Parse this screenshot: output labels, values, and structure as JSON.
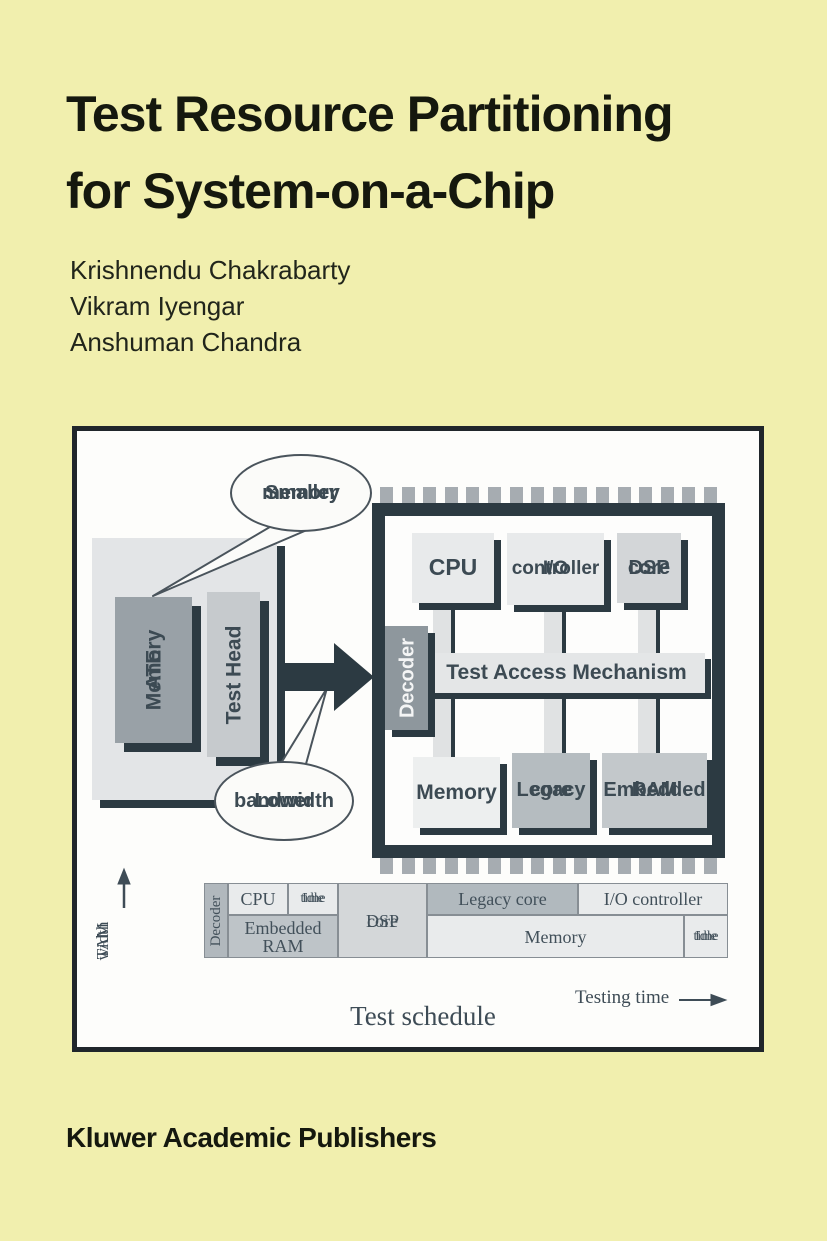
{
  "cover": {
    "title": [
      "Test Resource Partitioning",
      "for System-on-a-Chip"
    ],
    "authors": [
      "Krishnendu Chakrabarty",
      "Vikram Iyengar",
      "Anshuman Chandra"
    ],
    "publisher": "Kluwer Academic Publishers"
  },
  "colors": {
    "cover_background": "#f1efae",
    "dark_slate_accent": "#2c3a42",
    "diagram_label_text": "#3c4a53",
    "figure_border": "#20262b"
  },
  "figure": {
    "callouts": {
      "smaller_memory": [
        "Smaller",
        "memory"
      ],
      "lower_bandwidth": [
        "Lower",
        "bandwidth"
      ]
    },
    "ate": {
      "memory": [
        "ATE",
        "Memory"
      ],
      "test_head": "Test Head"
    },
    "chip": {
      "cpu": "CPU",
      "io": [
        "I/O",
        "controller"
      ],
      "dsp": [
        "DSP",
        "core"
      ],
      "decoder": "Decoder",
      "tam": "Test Access Mechanism",
      "memory": "Memory",
      "legacy": [
        "Legacy",
        "core"
      ],
      "ram": [
        "Embedded",
        "RAM"
      ],
      "pins_top": 16,
      "pins_bottom": 16
    },
    "schedule": {
      "tam_width": [
        "TAM",
        "width"
      ],
      "testing_time": "Testing time",
      "caption": "Test schedule",
      "cells": {
        "decoder": "Decoder",
        "cpu": "CPU",
        "idle_top": [
          "Idle",
          "time"
        ],
        "embedded_ram": "Embedded RAM",
        "dsp": [
          "DSP",
          "core"
        ],
        "legacy": "Legacy core",
        "io": "I/O controller",
        "memory": "Memory",
        "idle_bottom": [
          "Idle",
          "time"
        ]
      }
    }
  },
  "chart_data": {
    "type": "gantt",
    "title": "Test schedule",
    "xlabel": "Testing time",
    "ylabel": "TAM width",
    "axis_ticks": "none shown",
    "segments": [
      {
        "label": "Decoder",
        "row": "full",
        "start": 0.0,
        "end": 0.046
      },
      {
        "label": "CPU",
        "row": "top",
        "start": 0.046,
        "end": 0.16
      },
      {
        "label": "Idle time",
        "row": "top",
        "start": 0.16,
        "end": 0.256
      },
      {
        "label": "Embedded RAM",
        "row": "bottom",
        "start": 0.046,
        "end": 0.256
      },
      {
        "label": "DSP core",
        "row": "full",
        "start": 0.256,
        "end": 0.426
      },
      {
        "label": "Legacy core",
        "row": "top",
        "start": 0.426,
        "end": 0.714
      },
      {
        "label": "I/O controller",
        "row": "top",
        "start": 0.714,
        "end": 1.0
      },
      {
        "label": "Memory",
        "row": "bottom",
        "start": 0.426,
        "end": 0.916
      },
      {
        "label": "Idle time",
        "row": "bottom",
        "start": 0.916,
        "end": 1.0
      }
    ]
  }
}
